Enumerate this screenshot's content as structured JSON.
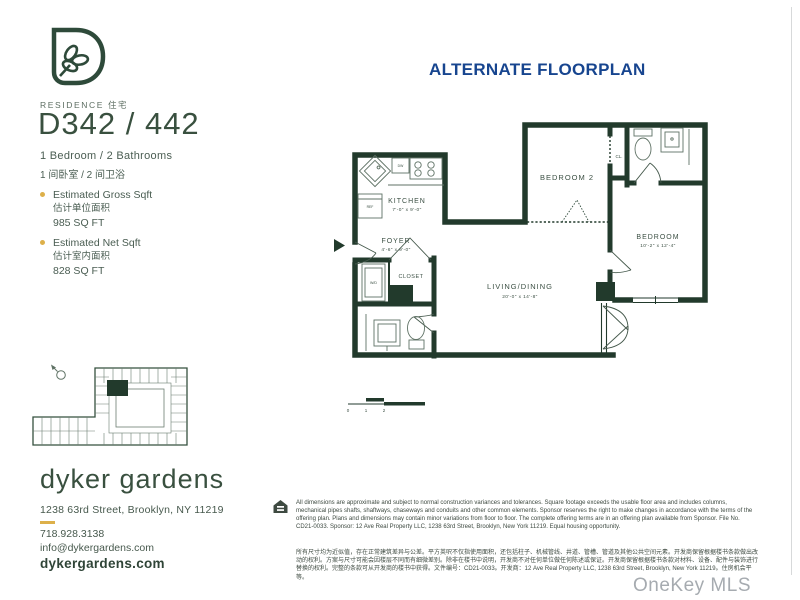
{
  "header": {
    "title": "ALTERNATE FLOORPLAN"
  },
  "residence": {
    "label": "RESIDENCE 住宅",
    "number": "D342 / 442",
    "beds_en": "1 Bedroom / 2 Bathrooms",
    "beds_zh": "1 间卧室 / 2 间卫浴",
    "gross": {
      "title": "Estimated Gross Sqft",
      "zh": "估计单位面积",
      "value": "985 SQ FT"
    },
    "net": {
      "title": "Estimated Net Sqft",
      "zh": "估计室内面积",
      "value": "828 SQ FT"
    }
  },
  "floorplan": {
    "kitchen": {
      "name": "KITCHEN",
      "dims": "7'-0\" x 9'-0\""
    },
    "foyer": {
      "name": "FOYER",
      "dims": "4'-6\" x 9'-0\""
    },
    "closet": {
      "name": "CLOSET"
    },
    "bedroom2": {
      "name": "BEDROOM 2"
    },
    "cl": {
      "name": "CL."
    },
    "bedroom": {
      "name": "BEDROOM",
      "dims": "10'-2\" x 12'-4\""
    },
    "living": {
      "name": "LIVING/DINING",
      "dims": "20'-0\" x 14'-8\""
    },
    "labels": {
      "dw": "DW",
      "ref": "REF",
      "wd": "W/D"
    },
    "scale_ticks": [
      "0",
      "1",
      "2",
      "4"
    ]
  },
  "contact": {
    "name": "dyker gardens",
    "address": "1238 63rd Street, Brooklyn, NY 11219",
    "phone": "718.928.3138",
    "email": "info@dykergardens.com",
    "website": "dykergardens.com"
  },
  "disclaimer": {
    "en": "All dimensions are approximate and subject to normal construction variances and tolerances. Square footage exceeds the usable floor area and includes columns, mechanical pipes shafts, shaftways, chaseways and conduits and other common elements. Sponsor reserves the right to make changes in accordance with the terms of the offering plan. Plans and dimensions may contain minor variations from floor to floor. The complete offering terms are in an offering plan available from Sponsor. File No. CD21-0033. Sponsor: 12 Ave Real Property LLC, 1238 63rd Street, Brooklyn, New York 11219. Equal housing opportunity.",
    "zh": "所有尺寸均为近似值，存在正常建筑差异与公差。平方英呎不仅指使用面积，还包括柱子、机械管线、井道、管槽、管道及其他公共空间元素。开发商保留根据楼书条款做出改动的权利。方案与尺寸可能会因楼层不同而有细微差别。除非在楼书中说明，开发商不对任何单位做任何陈述或保证。开发商保留根据楼书条款对材料、设备、配件与装饰进行替换的权利。完整的条款可从开发商的楼书中获得。文件编号：CD21-0033。开发商：12 Ave Real Property LLC, 1238 63rd Street, Brooklyn, New York 11219。住房机会平等。"
  },
  "watermark": "OneKey MLS"
}
